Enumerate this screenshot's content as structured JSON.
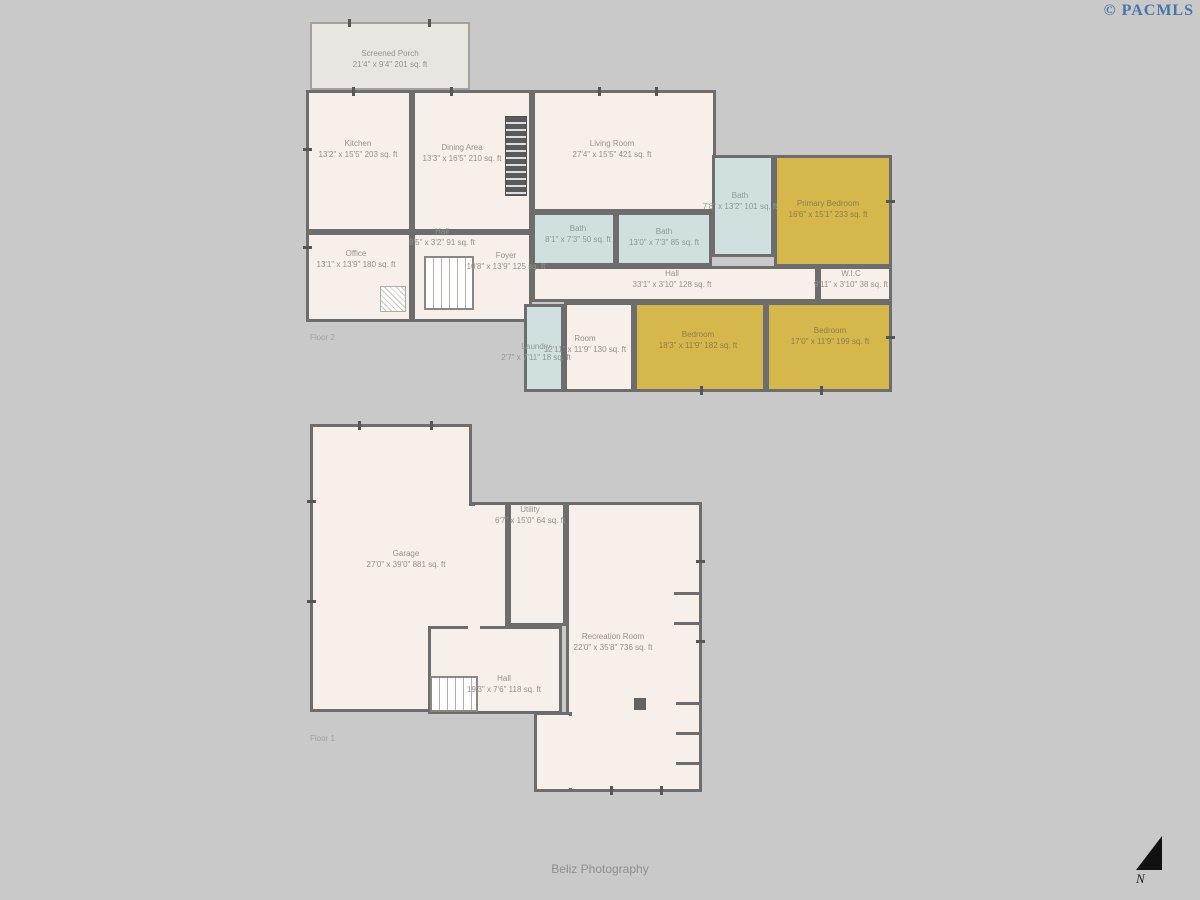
{
  "watermark": "© PACMLS",
  "credit": "Beliz Photography",
  "compass": "N",
  "colors": {
    "background": "#c9c9c9",
    "floor_cream": "#f7efe9",
    "porch_gray": "#e9e6e2",
    "bath_blue": "#cfe0df",
    "bedroom_gold": "#d6b74b",
    "wall": "#6d6d6d",
    "label_gray": "#97928d",
    "watermark_blue": "#4a74a8"
  },
  "floor2": {
    "label": "Floor 2",
    "rooms": {
      "porch": {
        "name": "Screened Porch",
        "dims": "21'4\" x 9'4\" 201 sq. ft"
      },
      "kitchen": {
        "name": "Kitchen",
        "dims": "13'2\" x 15'5\" 203 sq. ft"
      },
      "dining": {
        "name": "Dining Area",
        "dims": "13'3\" x 16'5\" 210 sq. ft"
      },
      "living": {
        "name": "Living Room",
        "dims": "27'4\" x 15'5\" 421 sq. ft"
      },
      "office": {
        "name": "Office",
        "dims": "13'1\" x 13'9\" 180 sq. ft"
      },
      "hall_upper": {
        "name": "Hall",
        "dims": "8'5\" x 3'2\" 91 sq. ft"
      },
      "foyer": {
        "name": "Foyer",
        "dims": "10'8\" x 13'9\" 125 sq. ft"
      },
      "bath_a": {
        "name": "Bath",
        "dims": "8'1\" x 7'3\" 50 sq. ft"
      },
      "bath_b": {
        "name": "Bath",
        "dims": "13'0\" x 7'3\" 85 sq. ft"
      },
      "bath_primary": {
        "name": "Bath",
        "dims": "7'8\" x 13'2\" 101 sq. ft"
      },
      "primary_bedroom": {
        "name": "Primary Bedroom",
        "dims": "16'6\" x 15'1\" 233 sq. ft"
      },
      "hall_main": {
        "name": "Hall",
        "dims": "33'1\" x 3'10\" 128 sq. ft"
      },
      "wic": {
        "name": "W.I.C",
        "dims": "9'11\" x 3'10\" 38 sq. ft"
      },
      "laundry": {
        "name": "Laundry",
        "dims": "2'7\" x 7'11\" 18 sq. ft"
      },
      "room": {
        "name": "Room",
        "dims": "12'11\" x 11'9\" 130 sq. ft"
      },
      "bedroom_a": {
        "name": "Bedroom",
        "dims": "18'3\" x 11'9\" 182 sq. ft"
      },
      "bedroom_b": {
        "name": "Bedroom",
        "dims": "17'0\" x 11'9\" 199 sq. ft"
      }
    }
  },
  "floor1": {
    "label": "Floor 1",
    "rooms": {
      "garage": {
        "name": "Garage",
        "dims": "27'0\" x 39'0\" 881 sq. ft"
      },
      "utility": {
        "name": "Utility",
        "dims": "6'7\" x 15'0\" 64 sq. ft"
      },
      "recreation": {
        "name": "Recreation Room",
        "dims": "22'0\" x 35'8\" 736 sq. ft"
      },
      "hall": {
        "name": "Hall",
        "dims": "19'3\" x 7'6\" 118 sq. ft"
      }
    }
  }
}
